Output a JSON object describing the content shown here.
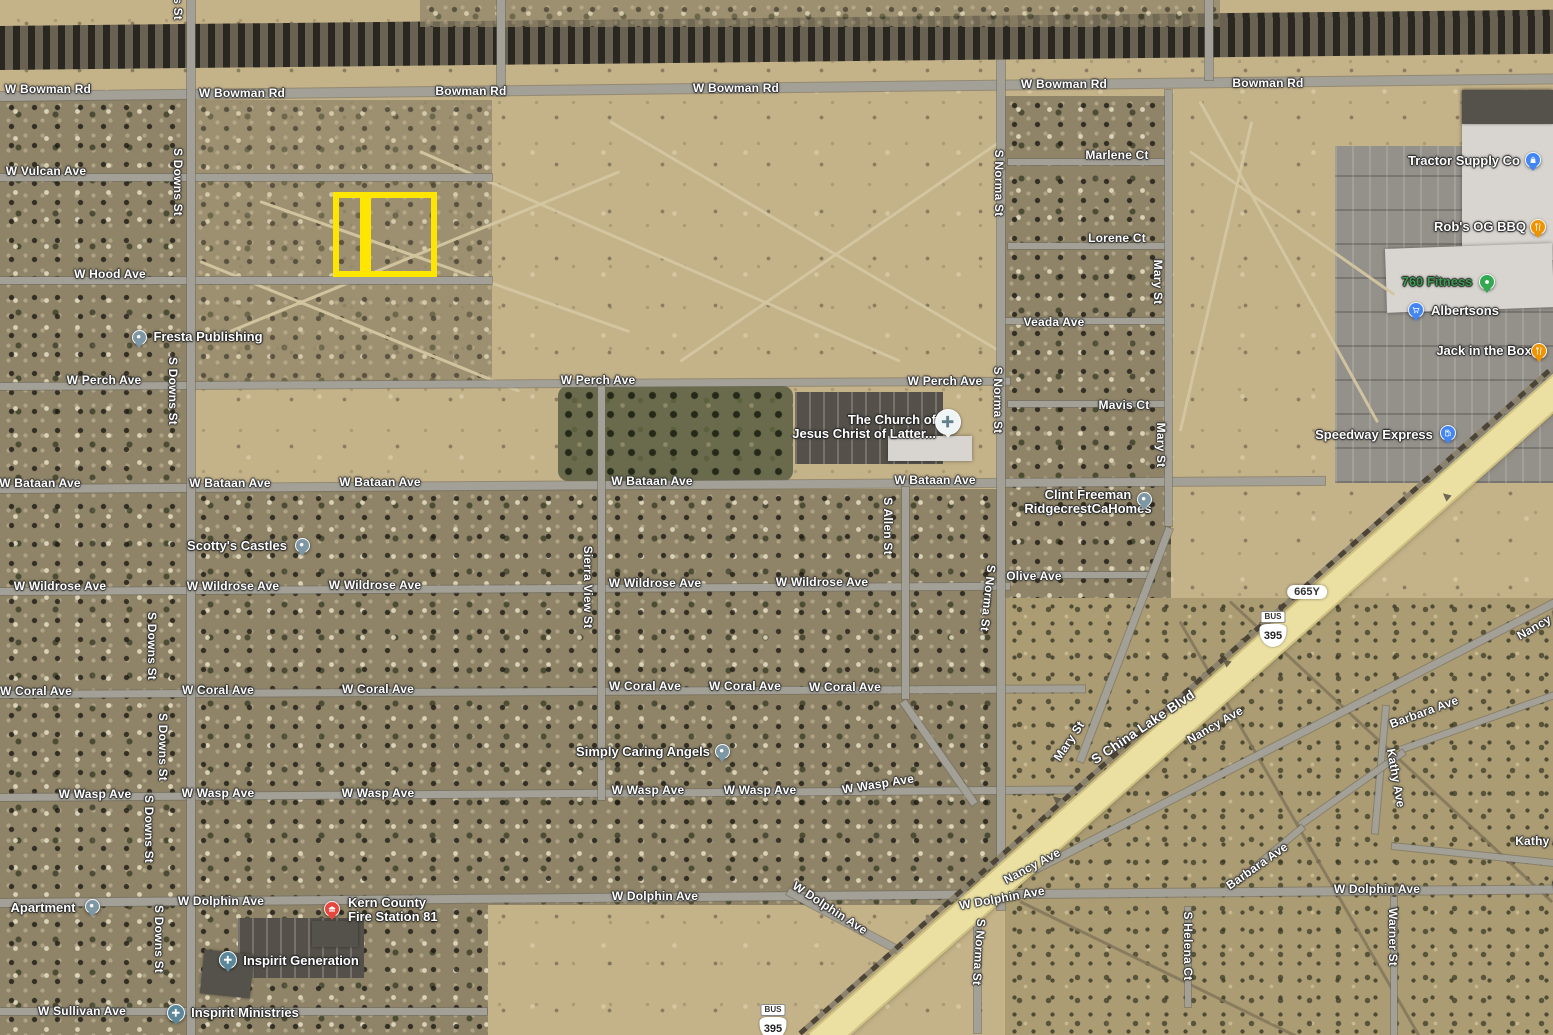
{
  "app": {
    "view": "satellite-map"
  },
  "palette": {
    "parcel_yellow": "#FFE600",
    "poi_blue": "#4285F4",
    "poi_orange": "#F09300",
    "poi_green": "#34A853",
    "poi_red": "#E8453C",
    "poi_slate": "#7E97A5",
    "worship_slate": "#5C8699",
    "church_light": "#EFF4F5",
    "fitness_text_green": "#3C9B51",
    "highway_fill": "#EBE0A2"
  },
  "highlight": {
    "color": "#FFE600",
    "cells": [
      {
        "x": 333,
        "y": 192,
        "w": 33,
        "h": 85
      },
      {
        "x": 365,
        "y": 192,
        "w": 72,
        "h": 85
      }
    ]
  },
  "road_labels": [
    {
      "text": "W Bowman Rd",
      "x": 48,
      "y": 89
    },
    {
      "text": "W Bowman Rd",
      "x": 242,
      "y": 93
    },
    {
      "text": "Bowman Rd",
      "x": 471,
      "y": 91
    },
    {
      "text": "W Bowman Rd",
      "x": 736,
      "y": 88
    },
    {
      "text": "W Bowman Rd",
      "x": 1064,
      "y": 84
    },
    {
      "text": "Bowman Rd",
      "x": 1268,
      "y": 83
    },
    {
      "text": "W Vulcan Ave",
      "x": 46,
      "y": 171
    },
    {
      "text": "W Hood Ave",
      "x": 110,
      "y": 274
    },
    {
      "text": "W Perch Ave",
      "x": 104,
      "y": 380
    },
    {
      "text": "W Perch Ave",
      "x": 598,
      "y": 380
    },
    {
      "text": "W Perch Ave",
      "x": 945,
      "y": 381
    },
    {
      "text": "W Bataan Ave",
      "x": 40,
      "y": 483
    },
    {
      "text": "W Bataan Ave",
      "x": 230,
      "y": 483
    },
    {
      "text": "W Bataan Ave",
      "x": 380,
      "y": 482
    },
    {
      "text": "W Bataan Ave",
      "x": 652,
      "y": 481
    },
    {
      "text": "W Bataan Ave",
      "x": 935,
      "y": 480
    },
    {
      "text": "W Wildrose Ave",
      "x": 60,
      "y": 586
    },
    {
      "text": "W Wildrose Ave",
      "x": 233,
      "y": 586
    },
    {
      "text": "W Wildrose Ave",
      "x": 375,
      "y": 585
    },
    {
      "text": "W Wildrose Ave",
      "x": 655,
      "y": 583
    },
    {
      "text": "W Wildrose Ave",
      "x": 822,
      "y": 582
    },
    {
      "text": "W Coral Ave",
      "x": 36,
      "y": 691
    },
    {
      "text": "W Coral Ave",
      "x": 218,
      "y": 690
    },
    {
      "text": "W Coral Ave",
      "x": 378,
      "y": 689
    },
    {
      "text": "W Coral Ave",
      "x": 645,
      "y": 686
    },
    {
      "text": "W Coral Ave",
      "x": 745,
      "y": 686
    },
    {
      "text": "W Coral Ave",
      "x": 845,
      "y": 687
    },
    {
      "text": "W Wasp Ave",
      "x": 95,
      "y": 794
    },
    {
      "text": "W Wasp Ave",
      "x": 218,
      "y": 793
    },
    {
      "text": "W Wasp Ave",
      "x": 378,
      "y": 793
    },
    {
      "text": "W Wasp Ave",
      "x": 648,
      "y": 790
    },
    {
      "text": "W Wasp Ave",
      "x": 760,
      "y": 790
    },
    {
      "text": "W Wasp Ave",
      "x": 878,
      "y": 784,
      "rot": -9
    },
    {
      "text": "W Dolphin Ave",
      "x": 221,
      "y": 901
    },
    {
      "text": "W Dolphin Ave",
      "x": 655,
      "y": 896
    },
    {
      "text": "W Dolphin Ave",
      "x": 830,
      "y": 908,
      "rot": 33
    },
    {
      "text": "W Dolphin Ave",
      "x": 1002,
      "y": 898,
      "rot": -10
    },
    {
      "text": "W Dolphin Ave",
      "x": 1377,
      "y": 889
    },
    {
      "text": "W Dolphin Ave",
      "x": 1596,
      "y": 886
    },
    {
      "text": "W Sullivan Ave",
      "x": 82,
      "y": 1011
    },
    {
      "text": "Marlene Ct",
      "x": 1117,
      "y": 155
    },
    {
      "text": "Lorene Ct",
      "x": 1117,
      "y": 238
    },
    {
      "text": "Veada Ave",
      "x": 1054,
      "y": 322
    },
    {
      "text": "Mavis Ct",
      "x": 1124,
      "y": 405
    },
    {
      "text": "Olive Ave",
      "x": 1034,
      "y": 576
    },
    {
      "text": "S Downs St",
      "x": 178,
      "y": -14,
      "vert": true
    },
    {
      "text": "S Downs St",
      "x": 178,
      "y": 182,
      "vert": true
    },
    {
      "text": "S Downs St",
      "x": 173,
      "y": 391,
      "vert": true
    },
    {
      "text": "S Downs St",
      "x": 152,
      "y": 646,
      "vert": true
    },
    {
      "text": "S Downs St",
      "x": 163,
      "y": 747,
      "vert": true
    },
    {
      "text": "S Downs St",
      "x": 149,
      "y": 829,
      "vert": true
    },
    {
      "text": "S Downs St",
      "x": 159,
      "y": 939,
      "vert": true
    },
    {
      "text": "Sierra View St",
      "x": 588,
      "y": 587,
      "vert": true
    },
    {
      "text": "S Allen St",
      "x": 888,
      "y": 526,
      "vert": true
    },
    {
      "text": "S Norma St",
      "x": 999,
      "y": 183,
      "vert": true
    },
    {
      "text": "S Norma St",
      "x": 998,
      "y": 400,
      "vert": true
    },
    {
      "text": "S Norma St",
      "x": 988,
      "y": 598,
      "vert": true,
      "rot": 96
    },
    {
      "text": "S Norma St",
      "x": 979,
      "y": 952,
      "vert": true,
      "rot": 94
    },
    {
      "text": "Mary St",
      "x": 1158,
      "y": 282,
      "vert": true
    },
    {
      "text": "Mary St",
      "x": 1161,
      "y": 445,
      "vert": true
    },
    {
      "text": "Mary St",
      "x": 1069,
      "y": 741,
      "rot": -56
    },
    {
      "text": "S China Lake Blvd",
      "x": 1143,
      "y": 727,
      "rot": -34,
      "size": "big"
    },
    {
      "text": "Nancy Ave",
      "x": 1032,
      "y": 866,
      "rot": -28
    },
    {
      "text": "Nancy Ave",
      "x": 1215,
      "y": 725,
      "rot": -30
    },
    {
      "text": "Nancy Ave",
      "x": 1545,
      "y": 621,
      "rot": -30
    },
    {
      "text": "Barbara Ave",
      "x": 1424,
      "y": 712,
      "rot": -20
    },
    {
      "text": "Barbara Ave",
      "x": 1257,
      "y": 866,
      "rot": -35
    },
    {
      "text": "Kathy Ave",
      "x": 1396,
      "y": 778,
      "rot": 80
    },
    {
      "text": "Kathy Ave",
      "x": 1545,
      "y": 841
    },
    {
      "text": "Warner St",
      "x": 1393,
      "y": 937,
      "vert": true
    },
    {
      "text": "S Helena Ct",
      "x": 1188,
      "y": 946,
      "vert": true
    }
  ],
  "pois": [
    {
      "name": "fresta-publishing",
      "lines": [
        "Fresta Publishing"
      ],
      "x": 208,
      "y": 337,
      "align": "center",
      "pin": {
        "x": 139,
        "y": 337,
        "color": "poi_slate",
        "icon": "dot",
        "d": 15
      }
    },
    {
      "name": "scottys-castles",
      "lines": [
        "Scotty's Castles"
      ],
      "x": 237,
      "y": 546,
      "align": "center",
      "pin": {
        "x": 302,
        "y": 545,
        "color": "poi_slate",
        "icon": "dot",
        "d": 15
      }
    },
    {
      "name": "simply-caring-angels",
      "lines": [
        "Simply Caring Angels"
      ],
      "x": 643,
      "y": 752,
      "align": "center",
      "pin": {
        "x": 722,
        "y": 751,
        "color": "poi_slate",
        "icon": "dot",
        "d": 15
      }
    },
    {
      "name": "church-of-jesus-christ-of-latter",
      "lines": [
        "The Church of",
        "Jesus Christ of Latter..."
      ],
      "x": 936,
      "y": 427,
      "align": "right",
      "pin": {
        "x": 948,
        "y": 422,
        "color": "church_light",
        "icon": "cross-dark",
        "d": 26
      }
    },
    {
      "name": "clint-freeman-ridgecrestcahomes",
      "lines": [
        "Clint Freeman",
        "RidgecrestCaHomes"
      ],
      "x": 1088,
      "y": 502,
      "align": "center",
      "pin": {
        "x": 1144,
        "y": 499,
        "color": "poi_slate",
        "icon": "dot",
        "d": 15
      }
    },
    {
      "name": "kern-county-fire-station-81",
      "lines": [
        "Kern County",
        "Fire Station 81"
      ],
      "x": 348,
      "y": 910,
      "align": "left",
      "pin": {
        "x": 332,
        "y": 909,
        "color": "poi_red",
        "icon": "fire",
        "d": 16
      }
    },
    {
      "name": "inspirit-generation",
      "lines": [
        "Inspirit Generation"
      ],
      "x": 301,
      "y": 961,
      "align": "center",
      "pin": {
        "x": 228,
        "y": 960,
        "color": "worship_slate",
        "icon": "cross",
        "d": 18
      }
    },
    {
      "name": "inspirit-ministries",
      "lines": [
        "Inspirit Ministries"
      ],
      "x": 245,
      "y": 1013,
      "align": "center",
      "pin": {
        "x": 176,
        "y": 1013,
        "color": "worship_slate",
        "icon": "cross",
        "d": 18
      }
    },
    {
      "name": "apartment",
      "lines": [
        "Apartment"
      ],
      "x": 43,
      "y": 908,
      "align": "center",
      "pin": {
        "x": 92,
        "y": 906,
        "color": "poi_slate",
        "icon": "dot",
        "d": 15
      }
    },
    {
      "name": "tractor-supply-co",
      "lines": [
        "Tractor Supply Co"
      ],
      "x": 1464,
      "y": 161,
      "align": "center",
      "pin": {
        "x": 1533,
        "y": 160,
        "color": "poi_blue",
        "icon": "bag",
        "d": 16
      }
    },
    {
      "name": "robs-og-bbq",
      "lines": [
        "Rob's OG BBQ"
      ],
      "x": 1480,
      "y": 227,
      "align": "center",
      "pin": {
        "x": 1538,
        "y": 227,
        "color": "poi_orange",
        "icon": "dining",
        "d": 16
      }
    },
    {
      "name": "760-fitness",
      "lines": [
        "760 Fitness"
      ],
      "x": 1437,
      "y": 282,
      "align": "center",
      "color": "#3C9B51",
      "pin": {
        "x": 1487,
        "y": 282,
        "color": "poi_green",
        "icon": "dot",
        "d": 16
      }
    },
    {
      "name": "albertsons",
      "lines": [
        "Albertsons"
      ],
      "x": 1465,
      "y": 311,
      "align": "center",
      "pin": {
        "x": 1416,
        "y": 310,
        "color": "poi_blue",
        "icon": "cart",
        "d": 16
      }
    },
    {
      "name": "jack-in-the-box",
      "lines": [
        "Jack in the Box"
      ],
      "x": 1484,
      "y": 351,
      "align": "center",
      "pin": {
        "x": 1539,
        "y": 351,
        "color": "poi_orange",
        "icon": "dining",
        "d": 16
      }
    },
    {
      "name": "speedway-express",
      "lines": [
        "Speedway Express"
      ],
      "x": 1374,
      "y": 435,
      "align": "center",
      "pin": {
        "x": 1448,
        "y": 433,
        "color": "poi_blue",
        "icon": "gas",
        "d": 16
      }
    }
  ],
  "shields": [
    {
      "kind": "us-bus-shield",
      "banner": "BUS",
      "number": "395",
      "x": 1273,
      "y": 629
    },
    {
      "kind": "us-bus-shield",
      "banner": "BUS",
      "number": "395",
      "x": 773,
      "y": 1022
    },
    {
      "kind": "route-pill",
      "text": "665Y",
      "x": 1307,
      "y": 592
    }
  ]
}
